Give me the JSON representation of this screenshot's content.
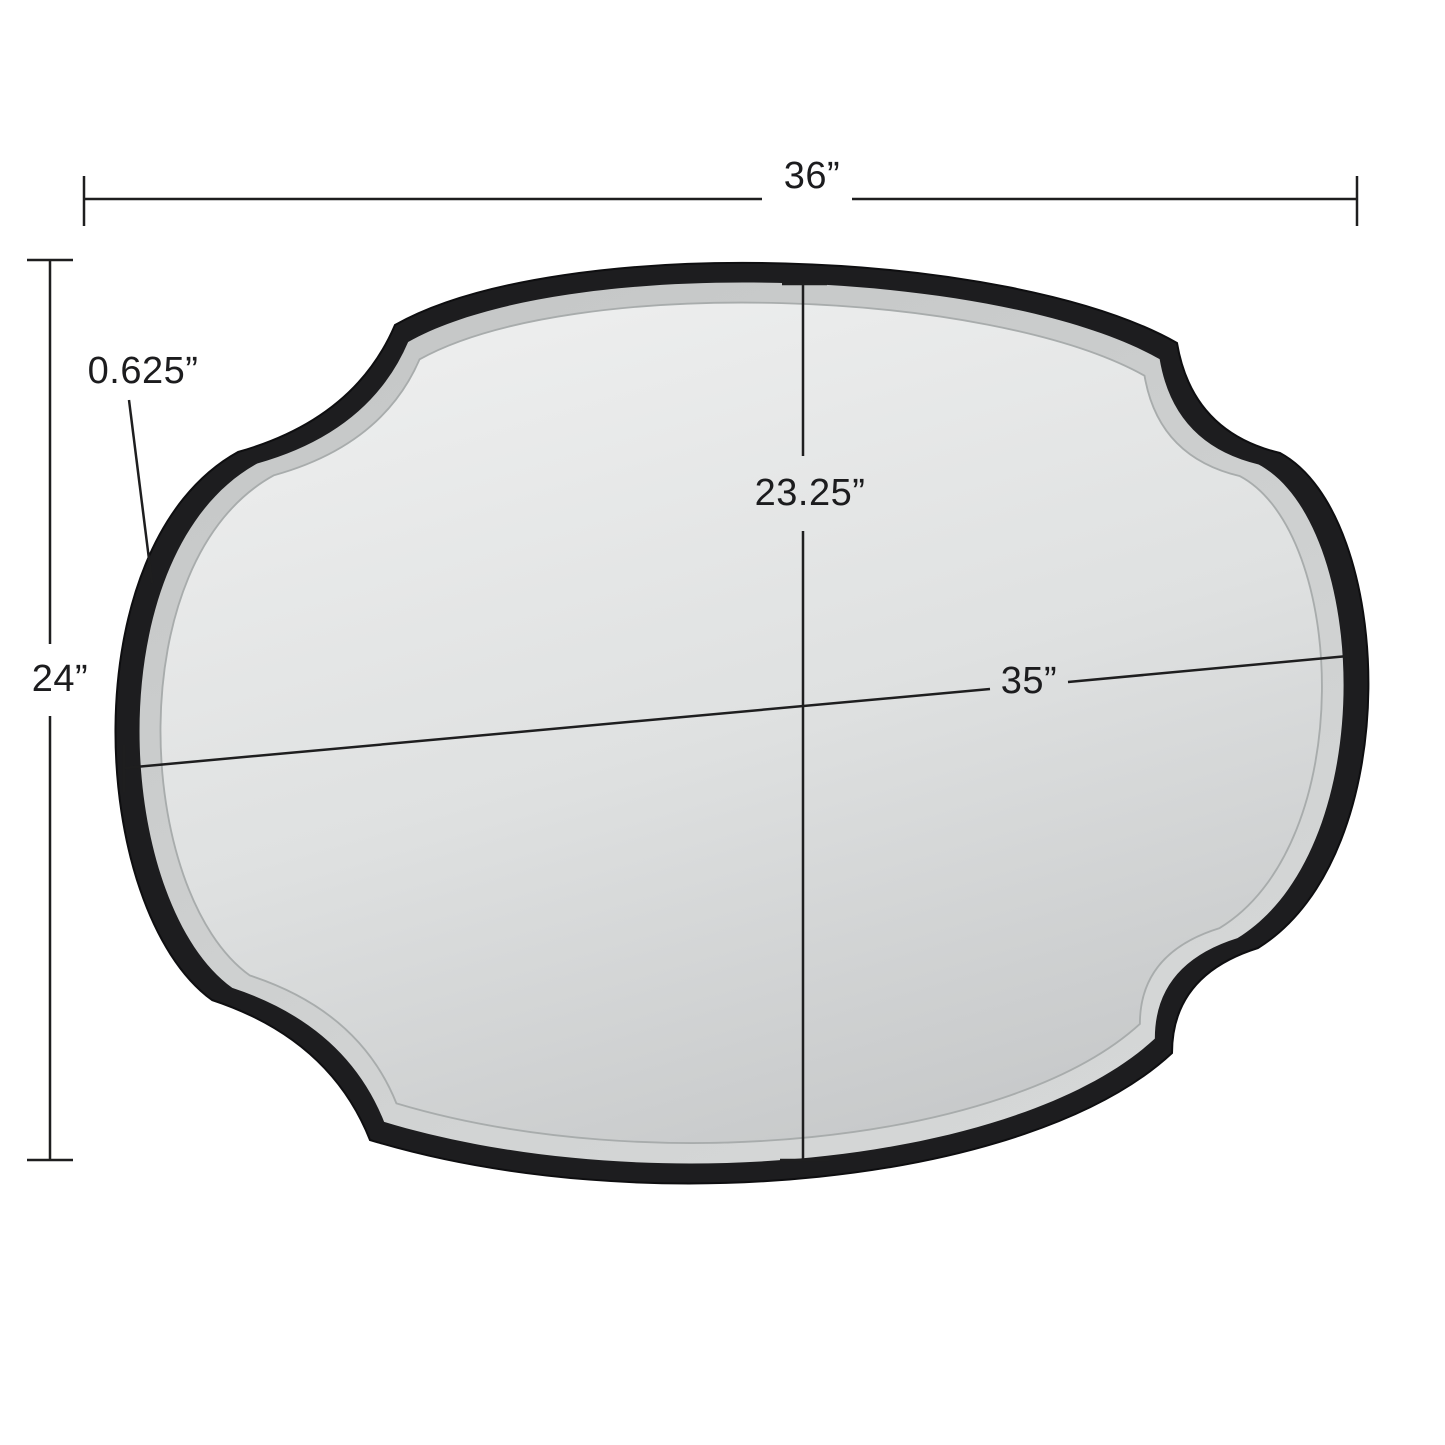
{
  "page": {
    "background": "#ffffff",
    "description": "Dimension diagram of a scalloped oval wall mirror with black frame"
  },
  "mirror": {
    "frame_color": "#1d1d1f",
    "frame_edge_color": "#0e0e10",
    "bevel_light": "#d6d8d8",
    "bevel_dark": "#c5c7c7",
    "face_light": "#edeeee",
    "face_mid": "#dfe1e1",
    "face_dark": "#c6c8c9",
    "bevel_line_color": "#a8acac"
  },
  "annotations": {
    "line_color": "#1e1e1f",
    "overall_width_label": "36”",
    "overall_height_label": "24”",
    "frame_width_label": "0.625”",
    "glass_height_label": "23.25”",
    "glass_width_label": "35”"
  }
}
